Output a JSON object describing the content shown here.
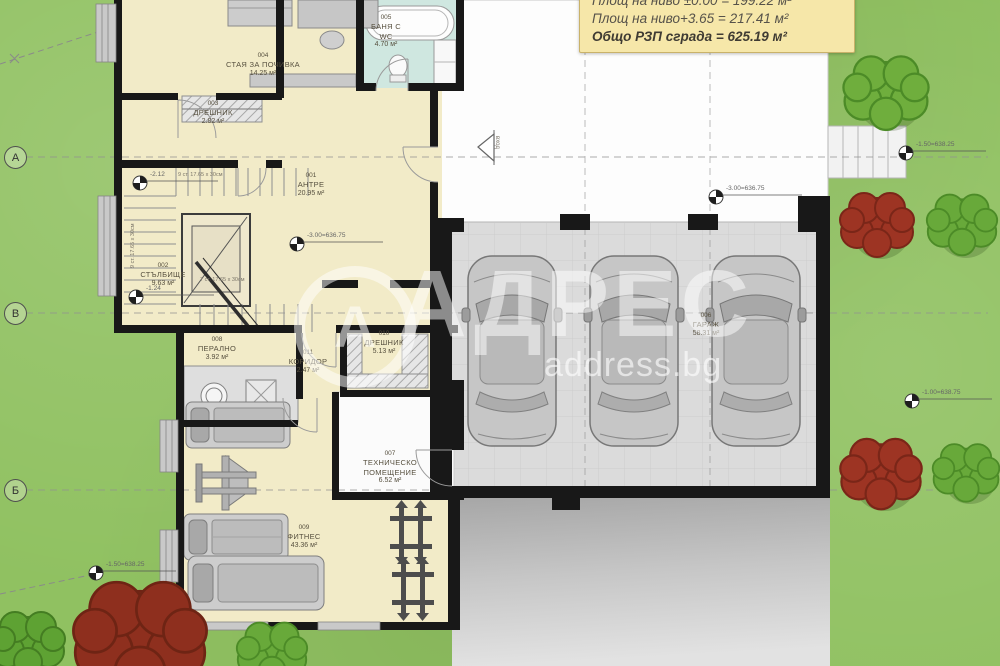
{
  "summary_box": {
    "line1": "Площ на ниво ±0.00 = 199.22 м²",
    "line2": "Площ на ниво+3.65 = 217.41 м²",
    "line3": "Общо РЗП сграда = 625.19 м²"
  },
  "watermark": {
    "initial": "А",
    "brand": "АДРЕС",
    "site": "address.bg"
  },
  "grid_rows": [
    {
      "label": "А"
    },
    {
      "label": "В"
    },
    {
      "label": "Б"
    }
  ],
  "rooms": [
    {
      "num": "004",
      "name": "СТАЯ ЗА ПОЧИВКА",
      "area": "14.25 м²"
    },
    {
      "num": "003",
      "name": "ДРЕШНИК",
      "area": "2.82 м²"
    },
    {
      "num": "005",
      "name": "БАНЯ С WC",
      "area": "4.70 м²"
    },
    {
      "num": "001",
      "name": "АНТРЕ",
      "area": "20.95 м²"
    },
    {
      "num": "002",
      "name": "СТЪЛБИЩЕ",
      "area": "9.63 м²"
    },
    {
      "num": "008",
      "name": "ПЕРАЛНО",
      "area": "3.92 м²"
    },
    {
      "num": "011",
      "name": "КОРИДОР",
      "area": "2.47 м²"
    },
    {
      "num": "010",
      "name": "ДРЕШНИК",
      "area": "5.13 м²"
    },
    {
      "num": "007",
      "name": "ТЕХНИЧЕСКО ПОМЕЩЕНИЕ",
      "area": "6.52 м²"
    },
    {
      "num": "009",
      "name": "ФИТНЕС",
      "area": "43.36 м²"
    },
    {
      "num": "006",
      "name": "ГАРАЖ",
      "area": "58.31 м²"
    }
  ],
  "markers": [
    {
      "label": "-2.12"
    },
    {
      "label": "-1.24"
    },
    {
      "label": "-3.00=636.75"
    },
    {
      "label": "-3.00=636.75"
    },
    {
      "label": "-1.50=638.25"
    },
    {
      "label": "-1.00=638.75"
    },
    {
      "label": "-1.50=638.25"
    }
  ],
  "stair_notes": {
    "flight_top": "9 ст. 17.65 х 30см",
    "flight_left": "9 ст. 17.65 х 30см",
    "flight_bottom": "7 ст. 17.65 х 30см"
  },
  "entrance_label": "вход",
  "colors": {
    "wall": "#181818",
    "floor_cream": "#f2ebc8",
    "floor_bath": "#cfe7e0",
    "garage_floor": "#dbdbdb",
    "grass": "#90c161",
    "summary_yellow": "#f6e7a9",
    "tree_red": "#9d3423",
    "tree_green": "#6fae3d"
  }
}
